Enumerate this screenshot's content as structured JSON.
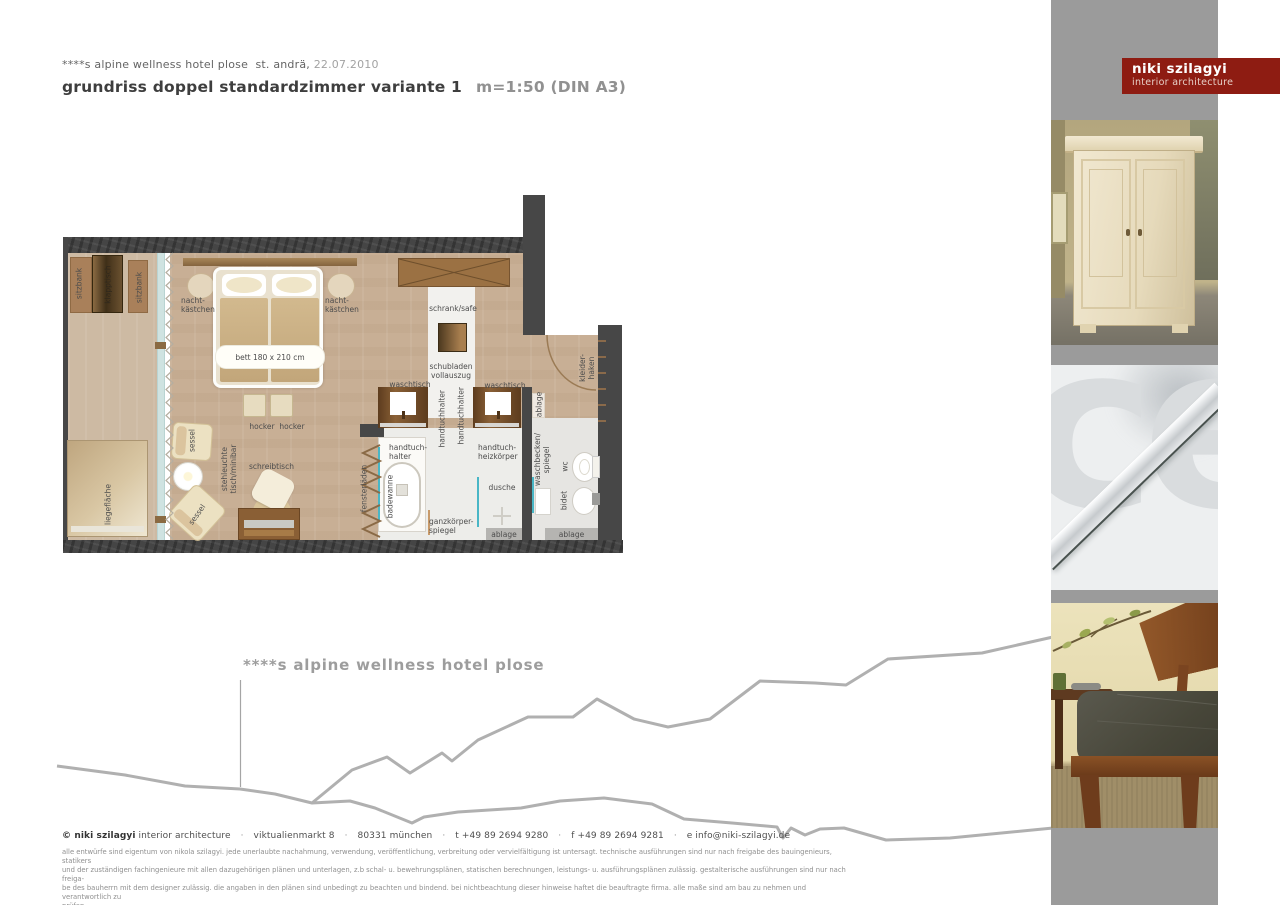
{
  "header": {
    "project": "****s alpine wellness hotel plose",
    "location": "st. andrä,",
    "date": "22.07.2010",
    "title": "grundriss doppel standardzimmer variante  1",
    "scale": "m=1:50 (DIN A3)"
  },
  "logo": {
    "name": "niki szilagyi",
    "subtitle": "interior architecture",
    "accent_color": "#8e1c12"
  },
  "plan": {
    "labels": {
      "sitzbank_1": "sitzbank",
      "klapptisch": "klapptisch",
      "sitzbank_2": "sitzbank",
      "nachtkaestchen_left": "nacht-\nkästchen",
      "nachtkaestchen_right": "nacht-\nkästchen",
      "bett": "bett 180 x 210 cm",
      "schrank_safe": "schrank/safe",
      "schubladen": "schubladen\nvollauszug",
      "waschtisch_left": "waschtisch",
      "waschtisch_right": "waschtisch",
      "handtuchhalter_left": "handtuchhalter",
      "handtuchhalter_right": "handtuchhalter",
      "ablage_entrance": "ablage",
      "kleiderhaken": "kleider-\nhaken",
      "hocker": "hocker  hocker",
      "sessel_1": "sessel",
      "sessel_2": "sessel",
      "stehleuchte": "stehleuchte\ntisch/minibar",
      "schreibtisch": "schreibtisch",
      "liegeflaeche": "liegefläche",
      "fensterlaeden": "fensterläden",
      "handtuchhalter_tub": "handtuch-\nhalter",
      "badewanne": "badewanne",
      "handtuch_heizkoerper": "handtuch-\nheizkörper",
      "dusche": "dusche",
      "ganzkoerperspiegel": "ganzkörper-\nspiegel",
      "ablage_bath_1": "ablage",
      "ablage_bath_2": "ablage",
      "waschbecken_spiegel": "waschbecken/\nspiegel",
      "wc": "wc",
      "bidet": "bidet"
    },
    "colors": {
      "wall": "#474747",
      "floor": "#c8af95",
      "glass": "#cfe3e1",
      "accent_cyan": "#49b6c6"
    }
  },
  "annotation": {
    "hotel_label": "****s alpine wellness hotel plose"
  },
  "sidebar": {
    "watermark": "ce",
    "gray": "#9b9b9b"
  },
  "footer": {
    "copyright": "© niki szilagyi",
    "studio": "interior architecture",
    "separator": "·",
    "address": "viktualienmarkt 8",
    "city": "80331 münchen",
    "phone": "t +49 89 2694 9280",
    "fax": "f +49 89 2694 9281",
    "email": "e info@niki-szilagyi.de",
    "legal_lines": [
      "alle entwürfe sind eigentum von nikola szilagyi. jede unerlaubte nachahmung, verwendung, veröffentlichung, verbreitung oder vervielfältigung ist untersagt. technische ausführungen sind nur nach freigabe des bauingenieurs, statikers",
      "und der zuständigen fachingenieure mit allen dazugehörigen plänen und unterlagen, z.b schal- u. bewehrungsplänen, statischen berechnungen, leistungs- u. ausführungsplänen zulässig. gestalterische ausführungen sind nur nach freiga-",
      "be des bauherrn mit dem designer zulässig. die angaben in den plänen sind unbedingt zu beachten und bindend. bei nichtbeachtung dieser hinweise haftet die beauftragte firma. alle maße sind am bau zu nehmen und verantwortlich zu",
      "prüfen."
    ]
  }
}
